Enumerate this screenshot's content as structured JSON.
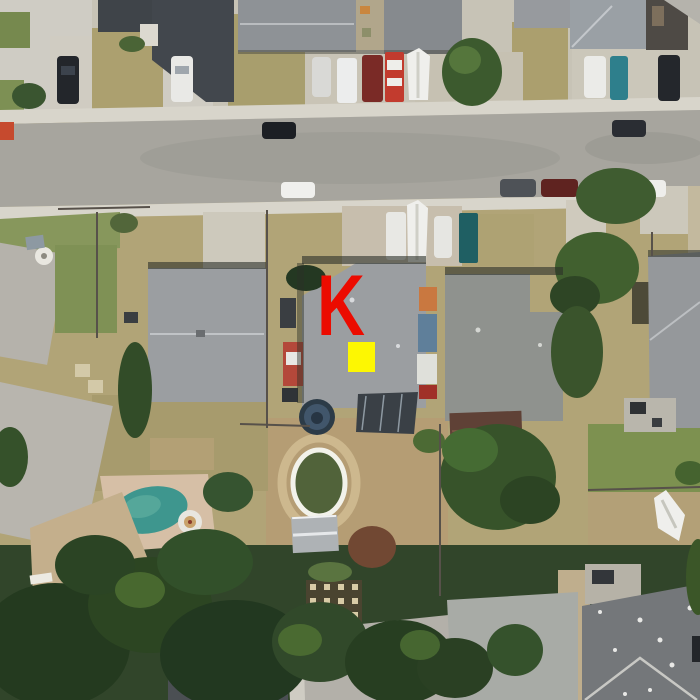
{
  "meta": {
    "view_type": "aerial satellite photo",
    "width_px": 700,
    "height_px": 700,
    "description": "Overhead satellite view of a suburban residential block: an east-west street across the upper portion, rows of single-family houses with gray roofs, driveways with parked cars and boats, dirt and grass backyards, an in-ground pool with hot tub, an above-ground pool, sheds, and dense trees along the bottom. A red letter K and a yellow square mark the roof of the center house."
  },
  "annotation": {
    "k_marker": {
      "label": "K",
      "color": "#ec0b00"
    },
    "target_marker": {
      "color": "#fdf702"
    }
  },
  "palette": {
    "base_dry_grass": "#b1a477",
    "north_concrete": "#c7c3b6",
    "big_driveway": "#cfccc4",
    "asphalt": "#a7a59e",
    "sidewalk": "#d8d5cb",
    "driveway_tan": "#c7bead",
    "green_grass": "#7d9150",
    "front_green_strip": "#87975c",
    "dirt_backyard": "#b59d74",
    "roof_dark": "#42474d",
    "roof_gray": "#9b9ea1",
    "roof_gray_b": "#8f928e",
    "roof_light": "#b5b2ab",
    "bottom_roof_dark": "#4b4f53",
    "tree_dark": "#273d20",
    "tree_mid": "#3f5c2e",
    "tree_light": "#4a6a31",
    "tree_red": "#714833",
    "pool_water": "#3e968e",
    "pool_deck": "#d6bfa6",
    "above_ground_pool": "#41566b",
    "shed_brown": "#5f4136",
    "boat_white": "#efefec"
  },
  "features": {
    "street_orientation": "horizontal",
    "houses_top_row": 6,
    "houses_middle_row": 5,
    "houses_bottom_row": 4,
    "in_ground_pool": 1,
    "hot_tub": 1,
    "above_ground_pool": 1,
    "boats": 3,
    "sheds": 2,
    "parked_vehicles_approx": 22
  }
}
